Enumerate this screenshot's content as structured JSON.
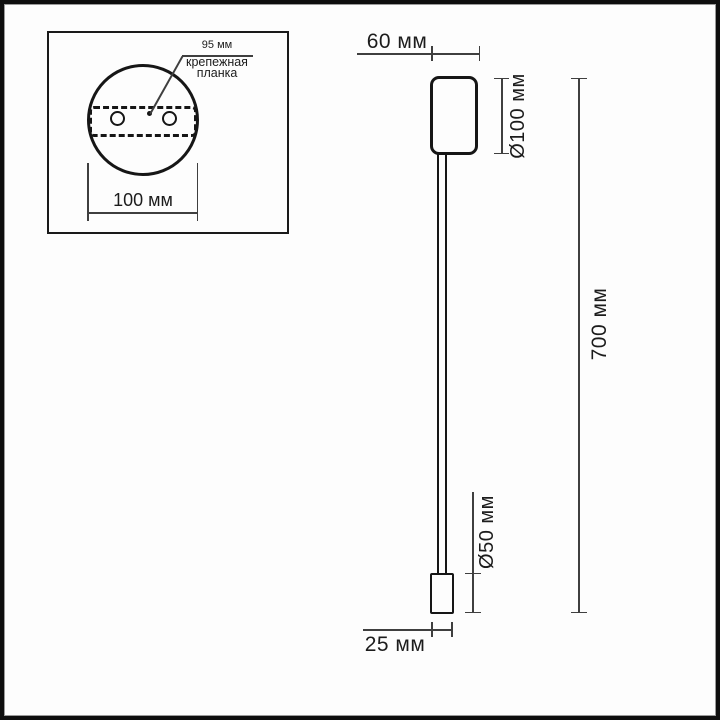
{
  "inset": {
    "dim_95": "95 мм",
    "mounting_label_line1": "крепежная",
    "mounting_label_line2": "планка",
    "dim_100": "100 мм"
  },
  "drawing": {
    "dim_top_width": "60 мм",
    "dim_body_diameter": "Ø100 мм",
    "dim_total_height": "700 мм",
    "dim_tube_diameter": "Ø50 мм",
    "dim_bottom_width": "25 мм"
  },
  "colors": {
    "background": "#fdfdfd",
    "frame": "#0e0e0e",
    "object_line": "#161616",
    "dimension_line": "#3f3f3f",
    "text": "#1c1c1c"
  }
}
